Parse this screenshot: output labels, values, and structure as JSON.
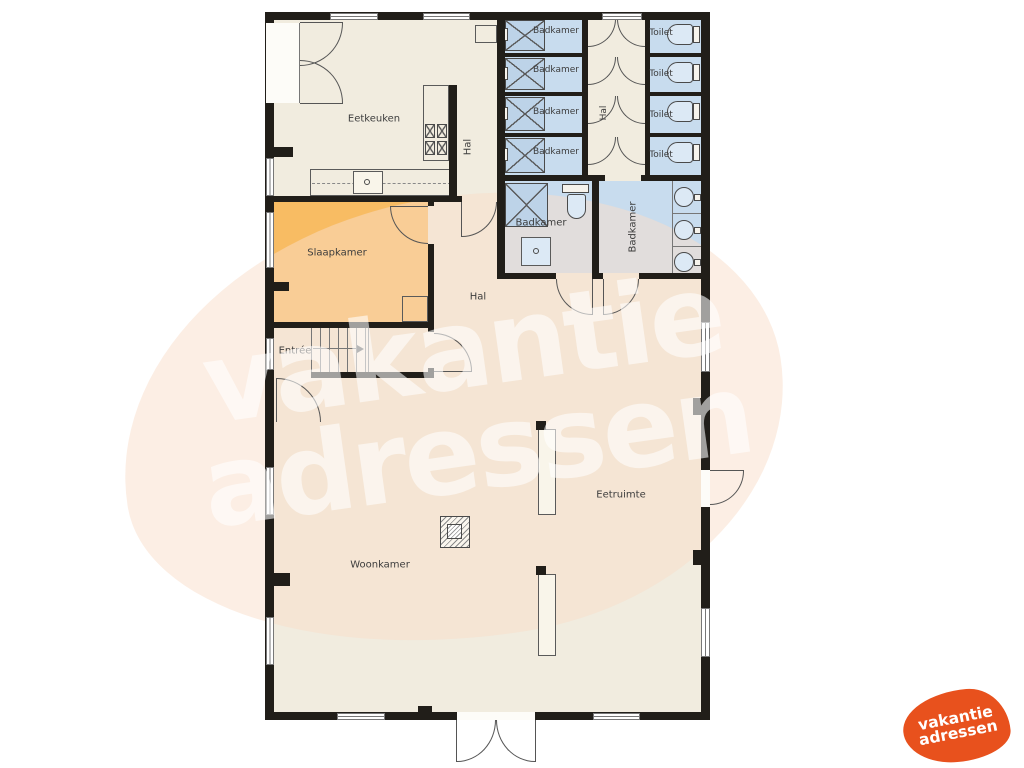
{
  "floorplan": {
    "labels": [
      {
        "text": "Eetkeuken",
        "x": 374,
        "y": 119,
        "fs": 10,
        "rot": 0
      },
      {
        "text": "Hal",
        "x": 468,
        "y": 147,
        "fs": 10,
        "rot": -90
      },
      {
        "text": "Badkamer",
        "x": 556,
        "y": 31,
        "fs": 9,
        "rot": 0
      },
      {
        "text": "Badkamer",
        "x": 556,
        "y": 70,
        "fs": 9,
        "rot": 0
      },
      {
        "text": "Badkamer",
        "x": 556,
        "y": 112,
        "fs": 9,
        "rot": 0
      },
      {
        "text": "Badkamer",
        "x": 556,
        "y": 152,
        "fs": 9,
        "rot": 0
      },
      {
        "text": "Toilet",
        "x": 661,
        "y": 33,
        "fs": 9,
        "rot": 0
      },
      {
        "text": "Toilet",
        "x": 661,
        "y": 74,
        "fs": 9,
        "rot": 0
      },
      {
        "text": "Toilet",
        "x": 661,
        "y": 115,
        "fs": 9,
        "rot": 0
      },
      {
        "text": "Toilet",
        "x": 661,
        "y": 155,
        "fs": 9,
        "rot": 0
      },
      {
        "text": "Hal",
        "x": 604,
        "y": 113,
        "fs": 9,
        "rot": -90
      },
      {
        "text": "Badkamer",
        "x": 541,
        "y": 223,
        "fs": 10,
        "rot": 0
      },
      {
        "text": "Badkamer",
        "x": 633,
        "y": 227,
        "fs": 10,
        "rot": -90
      },
      {
        "text": "Hal",
        "x": 478,
        "y": 297,
        "fs": 10,
        "rot": 0
      },
      {
        "text": "Slaapkamer",
        "x": 337,
        "y": 253,
        "fs": 10,
        "rot": 0
      },
      {
        "text": "Entrée",
        "x": 295,
        "y": 351,
        "fs": 10,
        "rot": 0
      },
      {
        "text": "Woonkamer",
        "x": 380,
        "y": 565,
        "fs": 10,
        "rot": 0
      },
      {
        "text": "Eetruimte",
        "x": 621,
        "y": 495,
        "fs": 10,
        "rot": 0
      }
    ],
    "colors": {
      "wall": "#211e19",
      "floor_cream": "#f1ecdf",
      "bathroom_blue": "#c8dcee",
      "bedroom_orange": "#f8bc63",
      "brand_orange": "#e8511d",
      "watermark_peach": "#f9ddca"
    }
  },
  "watermark": {
    "line1": "vakantie",
    "line2": "adressen"
  },
  "logo": {
    "line1": "vakantie",
    "line2": "adressen"
  }
}
